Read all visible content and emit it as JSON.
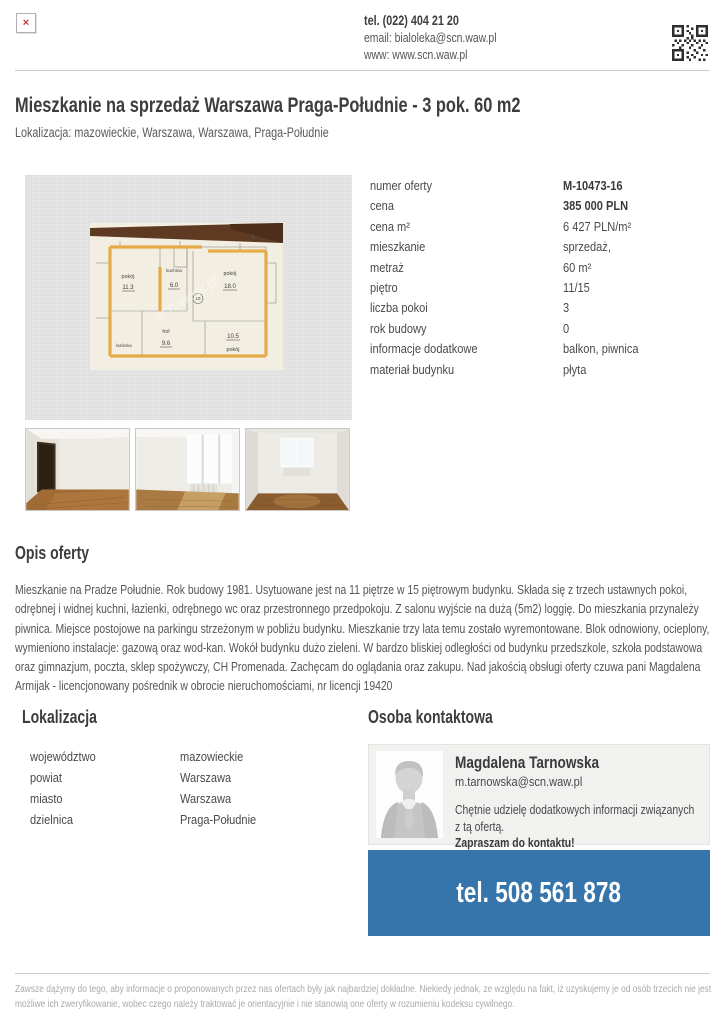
{
  "header": {
    "broken_image_glyph": "×",
    "phone": "tel. (022) 404 21 20",
    "email_line": "email: bialoleka@scn.waw.pl",
    "www_line": "www: www.scn.waw.pl"
  },
  "listing": {
    "title": "Mieszkanie na sprzedaż Warszawa Praga-Południe - 3 pok. 60 m2",
    "subtitle": "Lokalizacja: mazowieckie, Warszawa, Warszawa, Praga-Południe"
  },
  "details": {
    "rows": [
      {
        "label": "numer oferty",
        "value": "M-10473-16"
      },
      {
        "label": "cena",
        "value": "385 000 PLN"
      },
      {
        "label": "cena m²",
        "value": "6 427 PLN/m²"
      },
      {
        "label": "mieszkanie",
        "value": "sprzedaż,"
      },
      {
        "label": "metraż",
        "value": "60 m²"
      },
      {
        "label": "piętro",
        "value": "11/15"
      },
      {
        "label": "liczba pokoi",
        "value": "3"
      },
      {
        "label": "rok budowy",
        "value": "0"
      },
      {
        "label": "informacje dodatkowe",
        "value": "balkon, piwnica"
      },
      {
        "label": "materiał budynku",
        "value": "płyta"
      }
    ]
  },
  "floorplan": {
    "watermark": "scn.waw.pl",
    "room_left": "pokój",
    "room_left_area": "11.3",
    "kitchen": "kuchnia",
    "kitchen_area": "6.0",
    "room_right": "pokój",
    "room_right_area": "18.0",
    "hall": "hol",
    "hall_area": "9.6",
    "room_bottom": "pokój",
    "room_bottom_area": "10.5",
    "bathroom": "łazienka",
    "circle_mark": "10",
    "corner_digit": "9"
  },
  "description": {
    "heading": "Opis oferty",
    "text": "Mieszkanie na Pradze Południe. Rok budowy 1981. Usytuowane jest na 11 piętrze w 15 piętrowym budynku. Składa się z trzech ustawnych pokoi, odrębnej i widnej kuchni, łazienki, odrębnego wc oraz przestronnego przedpokoju. Z salonu wyjście na dużą (5m2) loggię. Do mieszkania przynależy piwnica. Miejsce postojowe na parkingu strzeżonym w pobliżu budynku. Mieszkanie trzy lata temu zostało wyremontowane. Blok odnowiony, ocieplony, wymieniono instalacje: gazową oraz wod-kan. Wokół budynku dużo zieleni. W bardzo bliskiej odległości od budynku przedszkole, szkoła podstawowa oraz gimnazjum, poczta, sklep spożywczy, CH Promenada. Zachęcam do oglądania oraz zakupu. Nad jakością obsługi oferty czuwa pani Magdalena Armijak - licencjonowany pośrednik w obrocie nieruchomościami, nr licencji 19420"
  },
  "location": {
    "heading": "Lokalizacja",
    "rows": [
      {
        "label": "województwo",
        "value": "mazowieckie"
      },
      {
        "label": "powiat",
        "value": "Warszawa"
      },
      {
        "label": "miasto",
        "value": "Warszawa"
      },
      {
        "label": "dzielnica",
        "value": "Praga-Południe"
      }
    ]
  },
  "contact": {
    "heading": "Osoba kontaktowa",
    "name": "Magdalena Tarnowska",
    "email": "m.tarnowska@scn.waw.pl",
    "message_line1": "Chętnie udzielę dodatkowych informacji związanych z tą ofertą.",
    "message_line2": "Zapraszam do kontaktu!",
    "phone": "tel. 508 561 878"
  },
  "footer": {
    "disclaimer": "Zawsze dążymy do tego, aby informacje o proponowanych przez nas ofertach były jak najbardziej dokładne. Niekiedy jednak, ze względu na fakt, iż uzyskujemy je od osób trzecich nie jest możliwe ich zweryfikowanie, wobec czego należy traktować je orientacyjnie i nie stanowią one oferty w rozumieniu kodeksu cywilnego."
  },
  "colors": {
    "accent_blue": "#3575ac",
    "broken_image_red": "#cc3333",
    "heading_text": "#3d3d3d",
    "body_text": "#555555",
    "muted_text": "#a9a9a9"
  }
}
